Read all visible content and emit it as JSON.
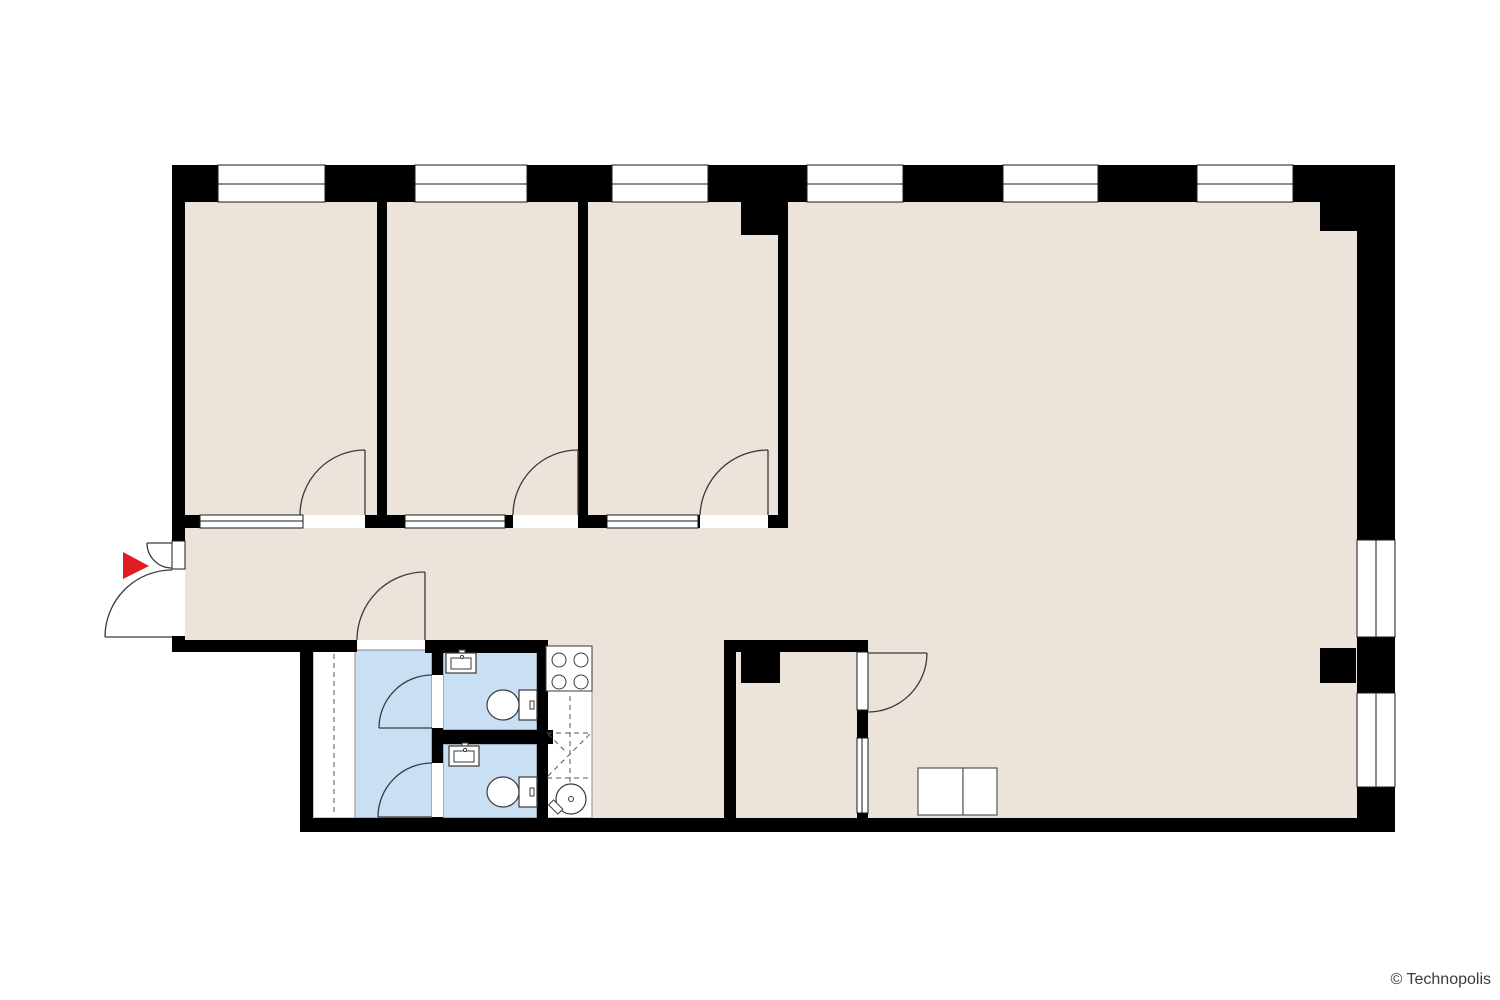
{
  "footer": {
    "copyright": "© Technopolis"
  },
  "palette": {
    "background": "#ffffff",
    "wall": "#000000",
    "floor": "#ece3da",
    "wet_area": "#c9dff4",
    "window_fill": "#ffffff",
    "line": "#3a3a3a",
    "counter_outline": "#999999",
    "accent_red": "#e11b22",
    "text": "#3c3c3c"
  },
  "plan": {
    "type": "office-floor-plan",
    "fixtures": {
      "entrance_marker": "red-arrow",
      "entrance_door": "double-leaf-outswing",
      "toilets": 2,
      "washbasins": 2,
      "stove_burners": 4,
      "kitchen_sink": 1,
      "wardrobe_dashed_rail": 1,
      "meeting_table_segments": 2,
      "door_swings": 9,
      "facade_windows_top": 6,
      "facade_windows_right": 2,
      "interior_glass_partitions": 4
    }
  }
}
